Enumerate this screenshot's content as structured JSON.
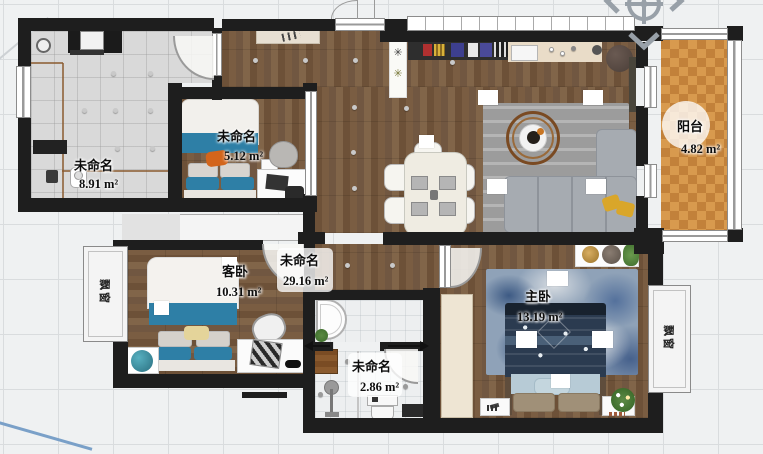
{
  "app": {
    "type": "floor-plan-editor-canvas"
  },
  "rooms": {
    "utility": {
      "name": "未命名",
      "area": "8.91 m²"
    },
    "bedroom_small": {
      "name": "未命名",
      "area": "5.12 m²"
    },
    "guest_bedroom": {
      "name": "客卧",
      "area": "10.31 m²"
    },
    "living_hall": {
      "name": "未命名",
      "area": "29.16 m²"
    },
    "master_bedroom": {
      "name": "主卧",
      "area": "13.19 m²"
    },
    "balcony": {
      "name": "阳台",
      "area": "4.82 m²"
    },
    "bathroom_small": {
      "name": "未命名",
      "area": "2.86 m²"
    }
  },
  "bay_windows": {
    "left": "飘窗",
    "right": "飘窗"
  },
  "icons": {
    "compass": "north-indicator"
  },
  "colors": {
    "wall": "#1e1e1e",
    "wood": "#745a42",
    "tile_gray": "#d9d9d9",
    "tile_white": "#edeff0",
    "balcony_a": "#d89a4e",
    "balcony_b": "#c2813a",
    "accent_blue": "#2e7fa6",
    "sofa_gray": "#a6abb1",
    "rug_gray": "#9c9c9c",
    "rug_blue": "#8fa2b8",
    "pillow_orange": "#d3651c",
    "pillow_yellow": "#d9a62a",
    "compass_gray": "#98a0a8",
    "guide_line_brown": "#8a5a2e",
    "diag_blue": "#7aa0c8"
  }
}
